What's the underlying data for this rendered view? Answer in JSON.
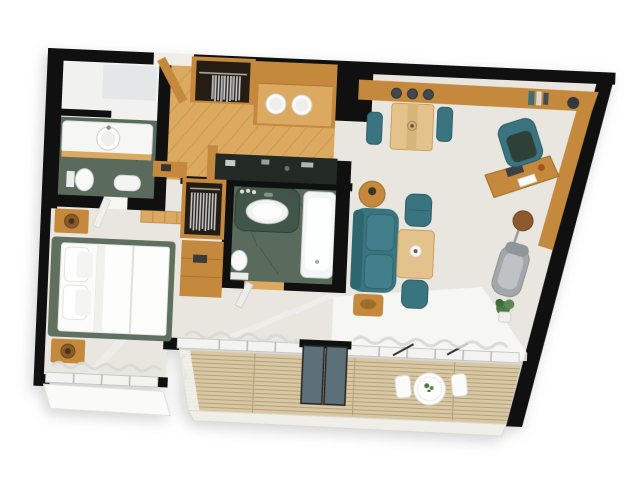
{
  "scene": {
    "title": "3D floor plan of a one-bedroom apartment, top-down view",
    "background": "#ffffff"
  },
  "colors": {
    "wall": "#101010",
    "floor": "#e9e6e0",
    "wood": "#c5893d",
    "wood-dark": "#9e6c28",
    "wood-light": "#dba95f",
    "beech": "#e4c28c",
    "teal": "#3a747e",
    "teal-dark": "#2b5f6a",
    "green-tile": "#5a6b5e",
    "green-marble": "#415549",
    "bed-frame": "#60705e",
    "deck": "#d8c7a2",
    "deck-line": "#b5a27c",
    "glass": "#5d6f79",
    "chaise": "#a3a7aa",
    "plant": "#4d7a48",
    "lamp": "#8a5a2e",
    "soft-white": "#f7f6f2"
  },
  "rooms": [
    {
      "name": "Guest Bathroom",
      "furniture": [
        "vanity",
        "round-basin",
        "toilet",
        "bidet",
        "mirror"
      ]
    },
    {
      "name": "Entry Hall",
      "furniture": [
        "entry-door",
        "wardrobe",
        "cabinet",
        "threshold"
      ]
    },
    {
      "name": "Kitchen",
      "furniture": [
        "wood-cabinets",
        "double-basin-counter",
        "dark-stone-counter"
      ]
    },
    {
      "name": "Bathroom",
      "furniture": [
        "stone-vanity",
        "oval-basin",
        "bathtub",
        "toilet",
        "door"
      ]
    },
    {
      "name": "Bedroom",
      "furniture": [
        "double-bed",
        "pillows",
        "nightstands",
        "table-lamps",
        "wardrobe",
        "dresser",
        "window",
        "curtains"
      ]
    },
    {
      "name": "Living & Dining Room",
      "furniture": [
        "credenza",
        "decor-vases",
        "dining-table",
        "dining-chairs",
        "sofa",
        "side-tables",
        "ottomans",
        "coffee-table",
        "desk",
        "office-chair",
        "laptop",
        "floor-lamp",
        "chaise-lounge",
        "plant",
        "rug"
      ]
    },
    {
      "name": "Balcony",
      "furniture": [
        "wood-deck",
        "sliding-glass-door",
        "round-table",
        "benches",
        "curtains"
      ]
    }
  ]
}
